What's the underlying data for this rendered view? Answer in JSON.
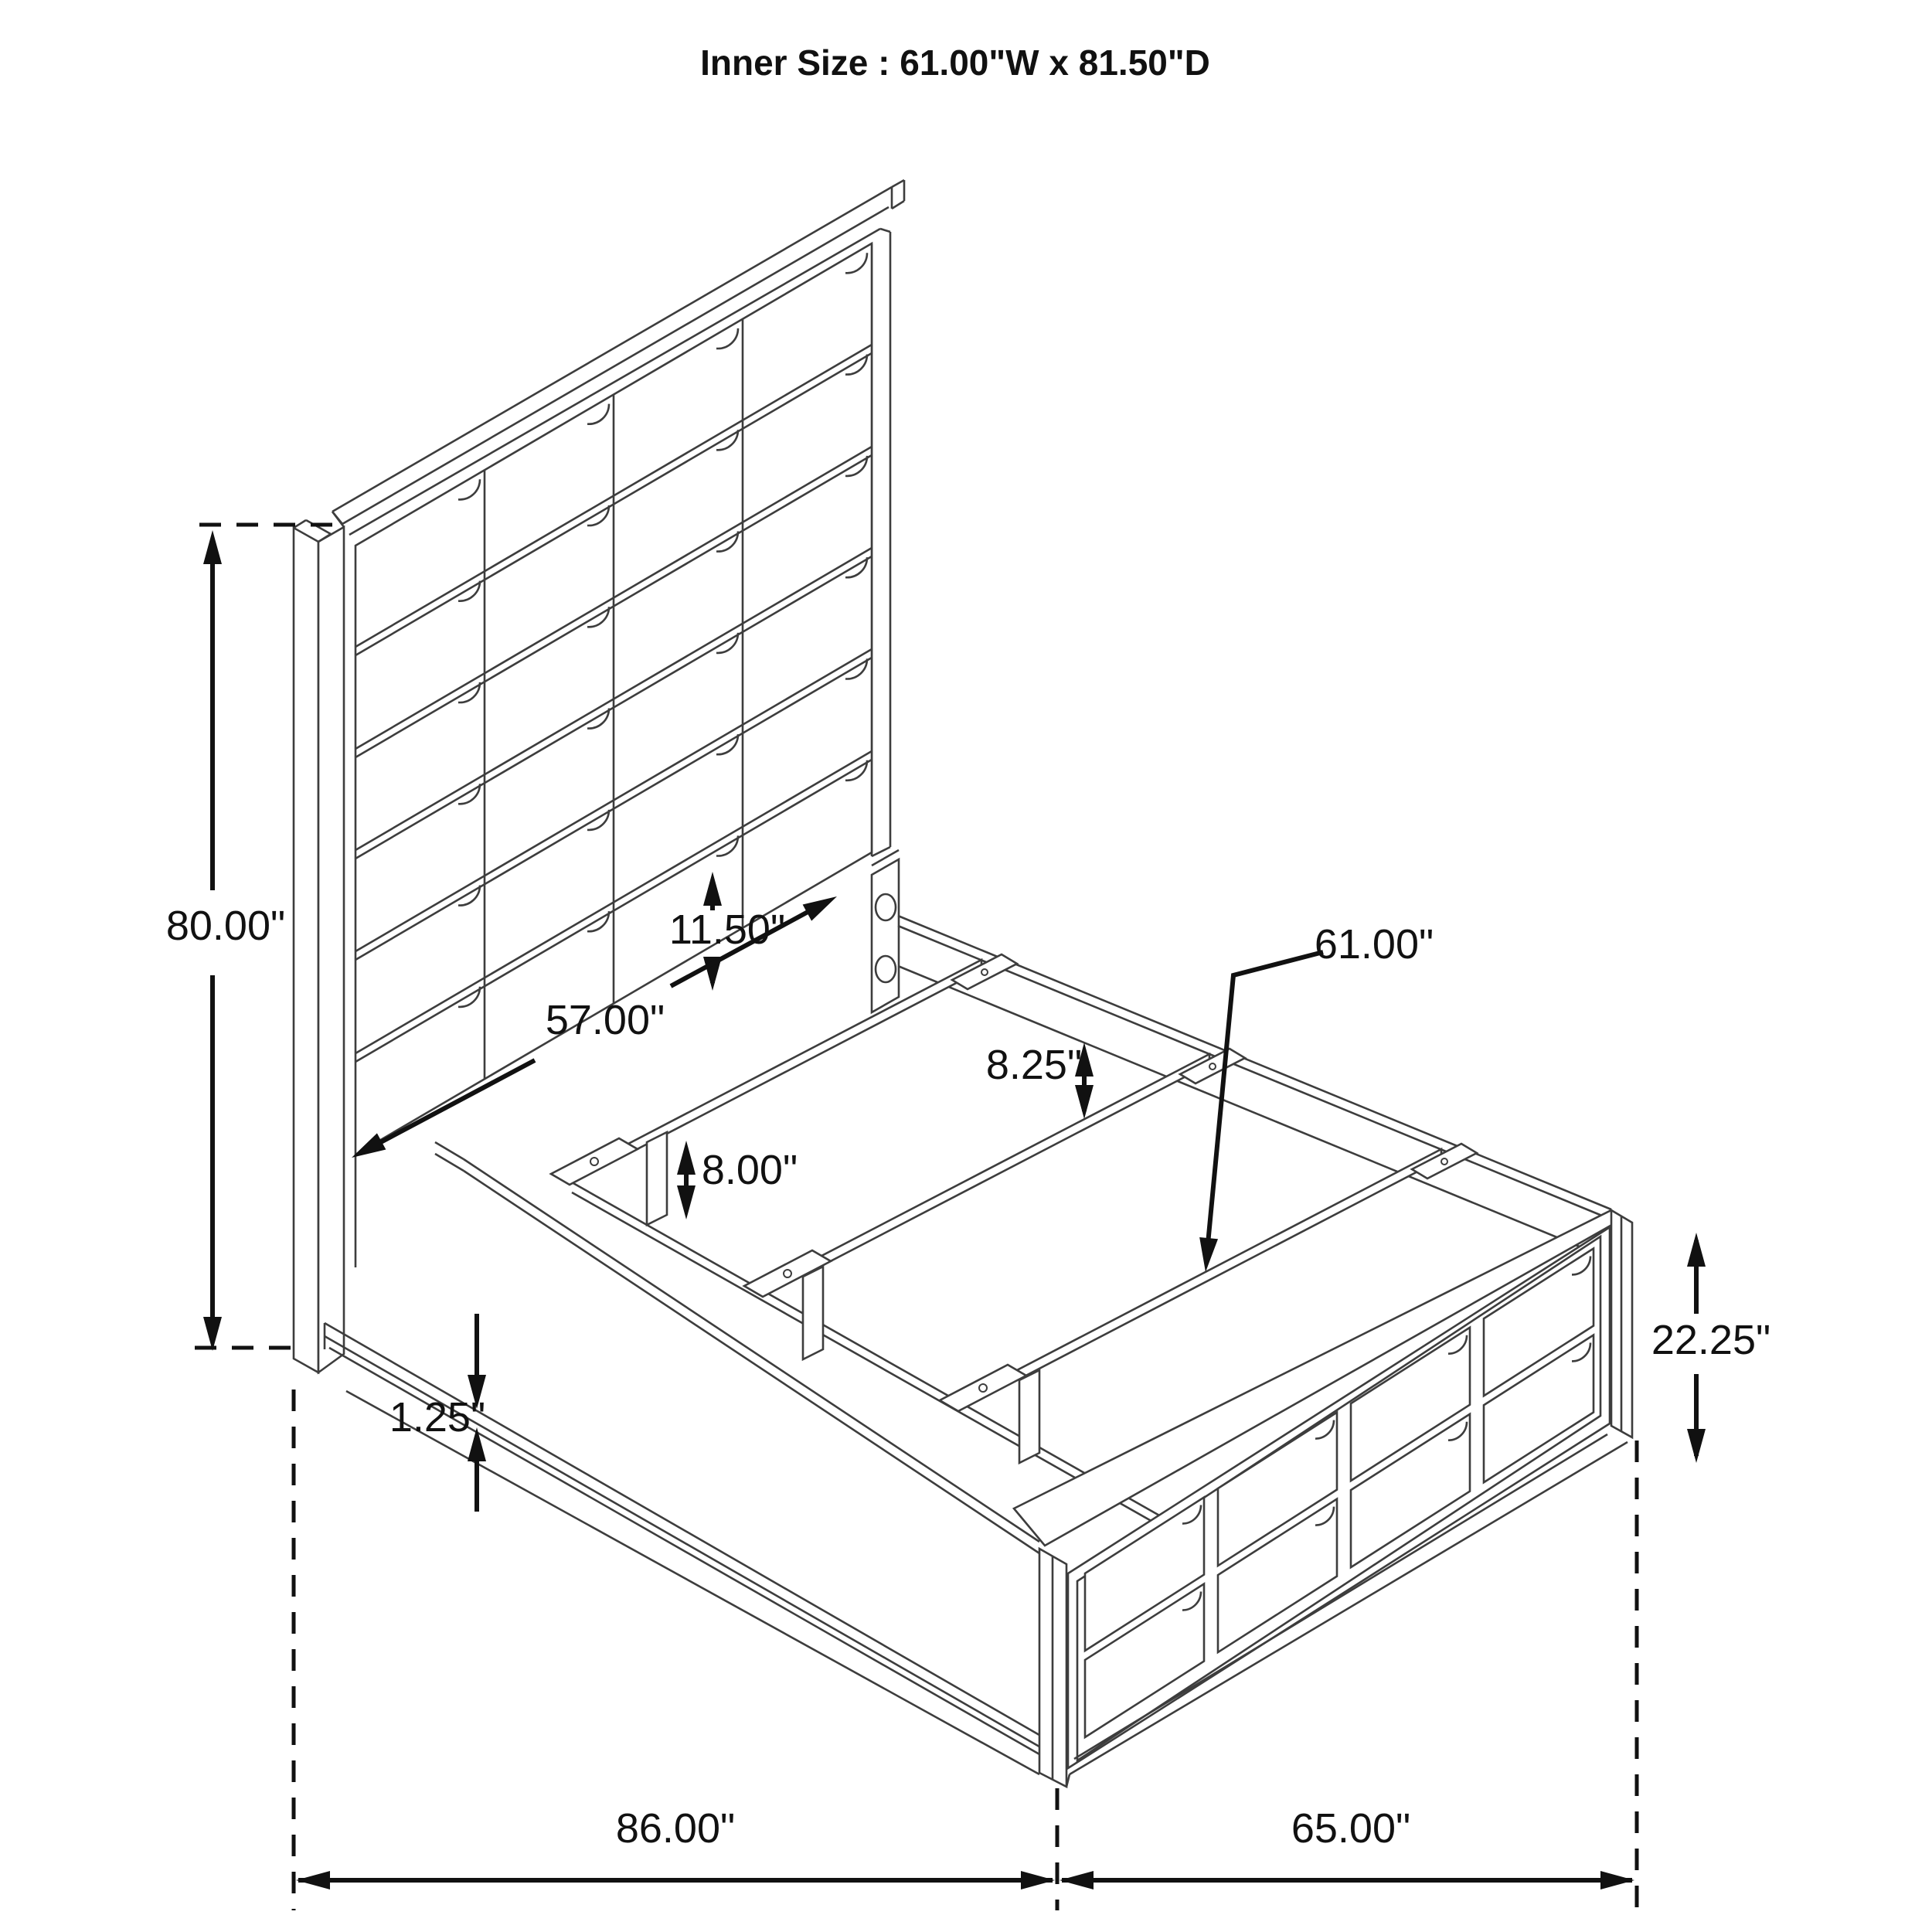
{
  "title": "Inner Size : 61.00\"W x 81.50\"D",
  "inner_size": {
    "width": "61.00\"W",
    "depth": "81.50\"D"
  },
  "dims": {
    "headboard_height": "80.00\"",
    "headboard_panel_lower": "11.50\"",
    "inner_rail_span": "57.00\"",
    "side_rail_height": "8.25\"",
    "slat_length": "61.00\"",
    "center_leg_height": "8.00\"",
    "rail_lip_thickness": "1.25\"",
    "footboard_height": "22.25\"",
    "overall_length": "86.00\"",
    "overall_width": "65.00\""
  },
  "colors": {
    "background": "#ffffff",
    "line": "#3d3d3d",
    "dimension": "#111111"
  }
}
